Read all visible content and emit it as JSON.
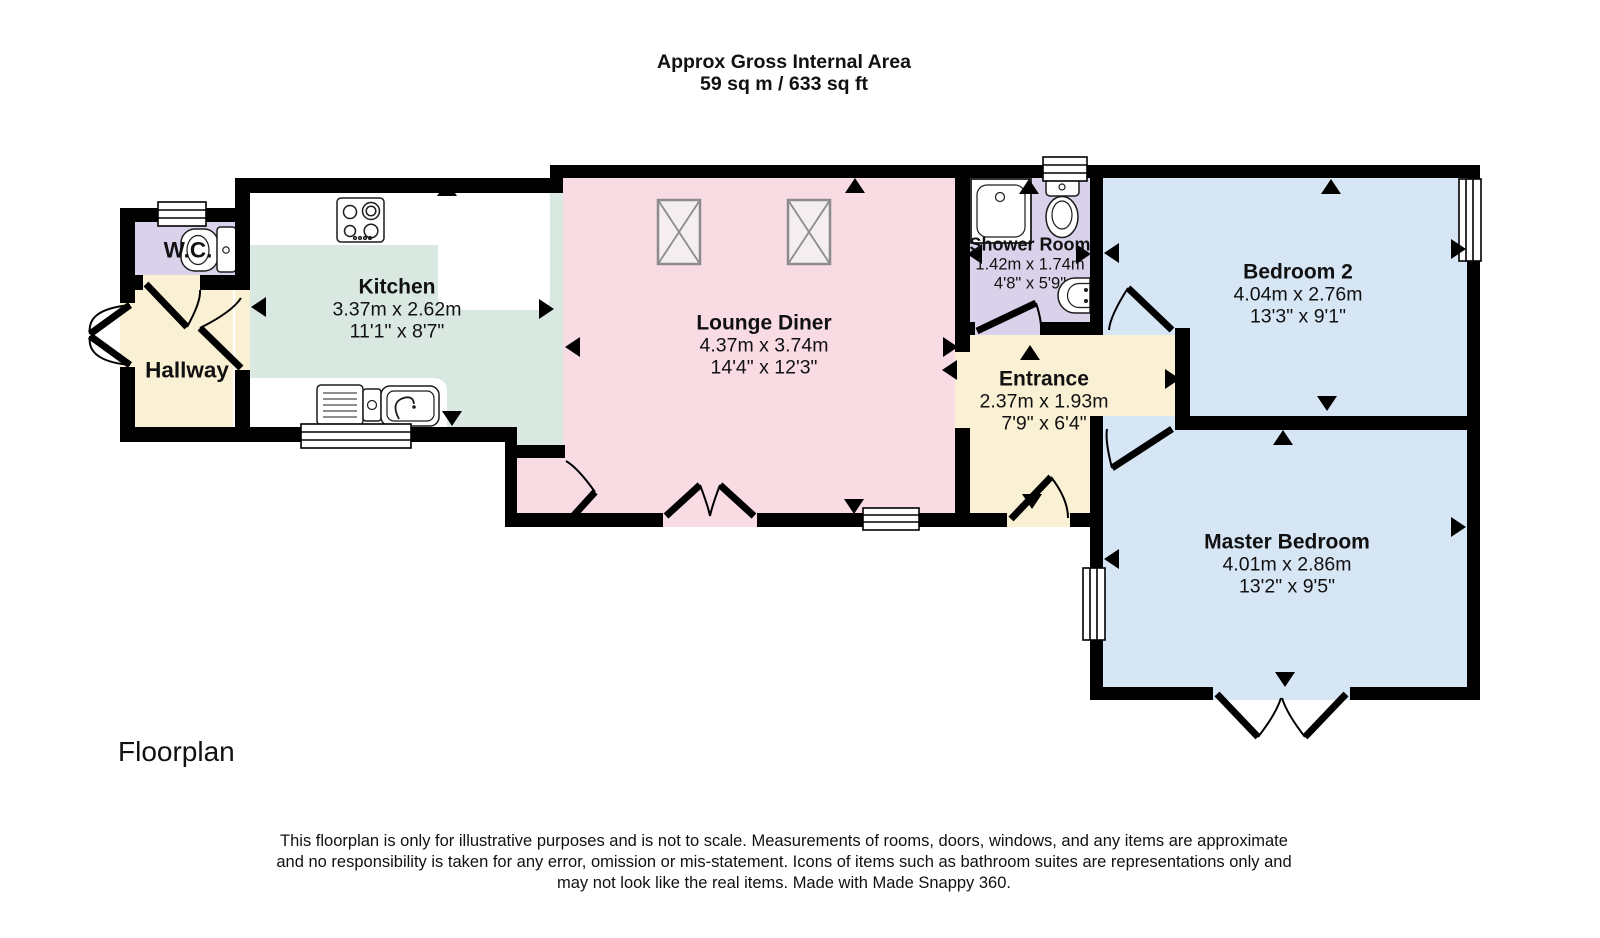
{
  "title": {
    "line1": "Approx Gross Internal Area",
    "line2": "59 sq m / 633 sq ft"
  },
  "rooms": [
    {
      "id": "wc",
      "name": "W.C.",
      "metric": "",
      "imperial": ""
    },
    {
      "id": "hallway",
      "name": "Hallway",
      "metric": "",
      "imperial": ""
    },
    {
      "id": "kitchen",
      "name": "Kitchen",
      "metric": "3.37m x 2.62m",
      "imperial": "11'1\" x 8'7\""
    },
    {
      "id": "lounge",
      "name": "Lounge Diner",
      "metric": "4.37m x 3.74m",
      "imperial": "14'4\" x 12'3\""
    },
    {
      "id": "shower",
      "name": "Shower Room",
      "metric": "1.42m x 1.74m",
      "imperial": "4'8\" x 5'9\""
    },
    {
      "id": "entrance",
      "name": "Entrance",
      "metric": "2.37m x 1.93m",
      "imperial": "7'9\" x 6'4\""
    },
    {
      "id": "bedroom2",
      "name": "Bedroom 2",
      "metric": "4.04m x 2.76m",
      "imperial": "13'3\" x 9'1\""
    },
    {
      "id": "master",
      "name": "Master Bedroom",
      "metric": "4.01m x 2.86m",
      "imperial": "13'2\" x 9'5\""
    }
  ],
  "footer": {
    "caption": "Floorplan",
    "disclaimer_lines": [
      "This floorplan is only for illustrative purposes and is not to scale. Measurements of rooms, doors, windows, and any items are approximate",
      "and no responsibility is taken for any error, omission or mis-statement. Icons of items such as bathroom suites are representations only and",
      "may not look like the real items. Made with Made Snappy 360."
    ]
  },
  "colors": {
    "kitchen_fill": "#d9e8e1",
    "lounge_fill": "#f9dce3",
    "bathroom_fill": "#d9d2ea",
    "hall_fill": "#faf0d4",
    "bedroom_fill": "#d6e6f5",
    "roofwin_fill": "#f4eef0",
    "roofwin_stroke": "#8c8c8c",
    "fixture_stroke": "#1c1c1c",
    "wall": "#000000",
    "text": "#111111"
  }
}
